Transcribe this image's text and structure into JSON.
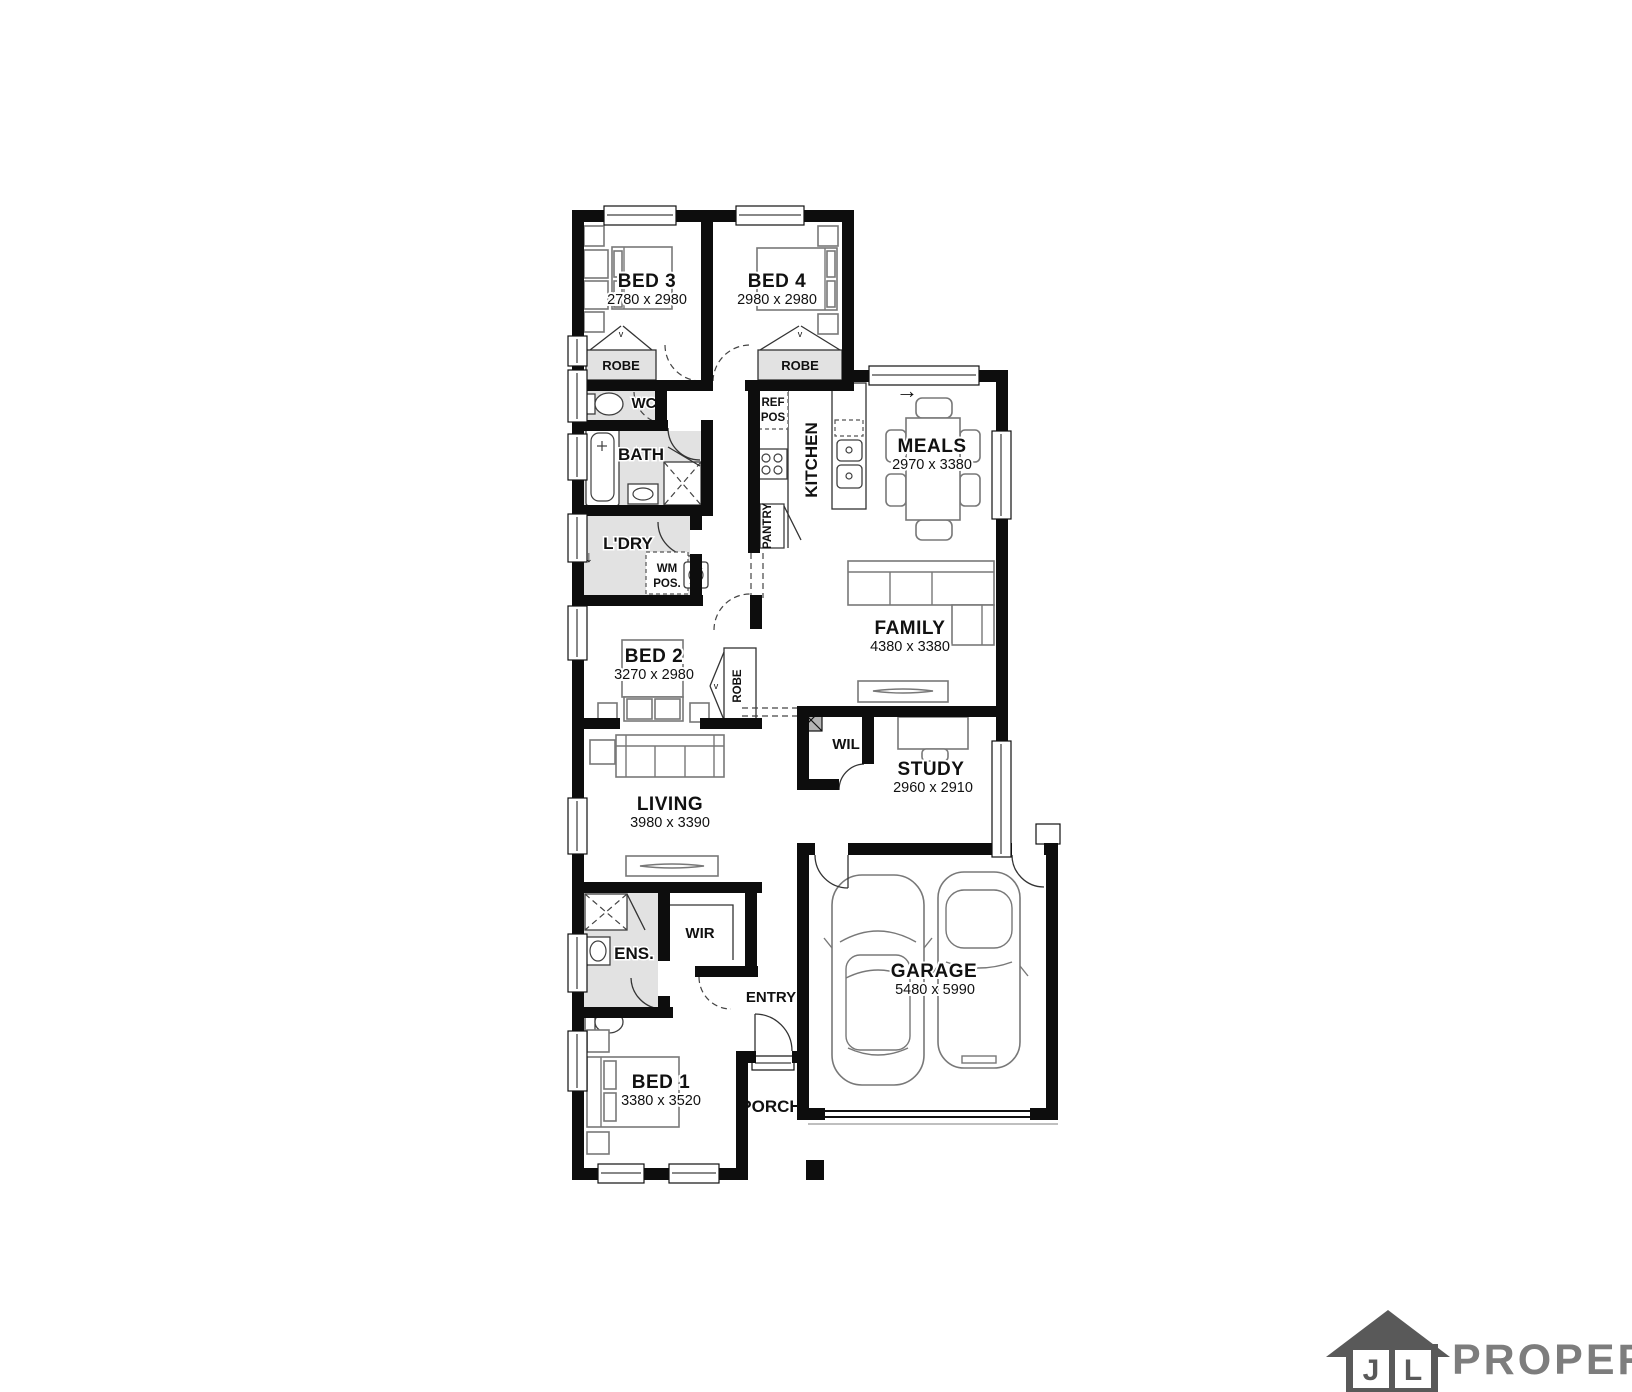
{
  "canvas": {
    "width": 1632,
    "height": 1392,
    "background": "#ffffff"
  },
  "floorplan": {
    "rooms": {
      "bed3": {
        "name": "BED 3",
        "dims": "2780 x 2980"
      },
      "bed4": {
        "name": "BED 4",
        "dims": "2980 x 2980"
      },
      "bed2": {
        "name": "BED 2",
        "dims": "3270 x 2980"
      },
      "bed1": {
        "name": "BED 1",
        "dims": "3380 x 3520"
      },
      "meals": {
        "name": "MEALS",
        "dims": "2970 x 3380"
      },
      "family": {
        "name": "FAMILY",
        "dims": "4380 x 3380"
      },
      "living": {
        "name": "LIVING",
        "dims": "3980 x 3390"
      },
      "study": {
        "name": "STUDY",
        "dims": "2960 x 2910"
      },
      "garage": {
        "name": "GARAGE",
        "dims": "5480 x 5990"
      }
    },
    "zones": {
      "robe": "ROBE",
      "wc": "WC",
      "bath": "BATH",
      "ldry": "L'DRY",
      "wm1": "WM",
      "wm2": "POS.",
      "ref1": "REF",
      "ref2": "POS",
      "pantry": "PANTRY",
      "kitchen": "KITCHEN",
      "wil": "WIL",
      "ens": "ENS.",
      "wir": "WIR",
      "entry": "ENTRY",
      "porch": "PORCH"
    },
    "icons": {
      "entry_arrow": "→",
      "ldry_arrow": "↓",
      "robe_marker": "v"
    }
  },
  "logo": {
    "letter1": "J",
    "letter2": "L",
    "wordmark": "PROPERTY"
  },
  "palette": {
    "wall": "#0d0d0d",
    "wet_area": "#e2e2e2",
    "furniture_stroke": "#787878",
    "logo_house": "#595959",
    "logo_text": "#7d7d7d"
  }
}
